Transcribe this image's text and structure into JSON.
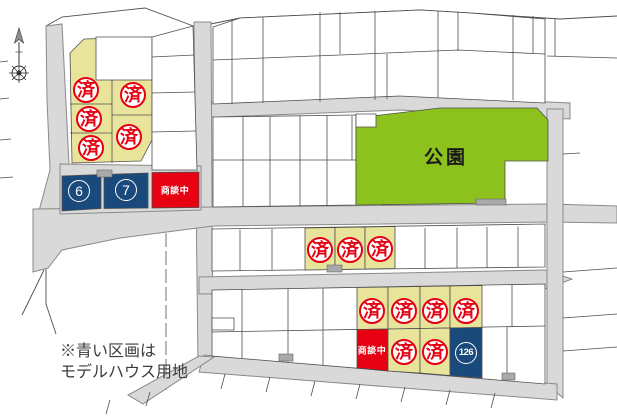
{
  "map_title": "housing-lot-map",
  "park": {
    "label": "公園"
  },
  "note": {
    "line1": "※青い区画は",
    "line2": "モデルハウス用地"
  },
  "markers": {
    "sold_label": "済",
    "sold_positions": [
      {
        "x": 86,
        "y": 90
      },
      {
        "x": 89,
        "y": 119
      },
      {
        "x": 91,
        "y": 148
      },
      {
        "x": 133,
        "y": 95
      },
      {
        "x": 129,
        "y": 137
      },
      {
        "x": 320,
        "y": 250
      },
      {
        "x": 350,
        "y": 250
      },
      {
        "x": 380,
        "y": 249
      },
      {
        "x": 372,
        "y": 311
      },
      {
        "x": 404,
        "y": 311
      },
      {
        "x": 435,
        "y": 311
      },
      {
        "x": 466,
        "y": 311
      },
      {
        "x": 404,
        "y": 352
      },
      {
        "x": 435,
        "y": 352
      }
    ],
    "negotiating_label": "商談中",
    "negotiating_positions": [
      {
        "x": 175,
        "y": 190
      },
      {
        "x": 372,
        "y": 350
      }
    ],
    "model_house_lots": [
      {
        "label": "6",
        "x": 79,
        "y": 191
      },
      {
        "label": "7",
        "x": 126,
        "y": 190
      },
      {
        "label": "126",
        "x": 466,
        "y": 353
      }
    ]
  },
  "colors": {
    "yellow": "#e9e49c",
    "red": "#e60012",
    "navy": "#1a4a7c",
    "green": "#8dc21e",
    "road": "#d9d9da",
    "road-edge": "#8a8a8a",
    "line": "#4e4e4e"
  }
}
